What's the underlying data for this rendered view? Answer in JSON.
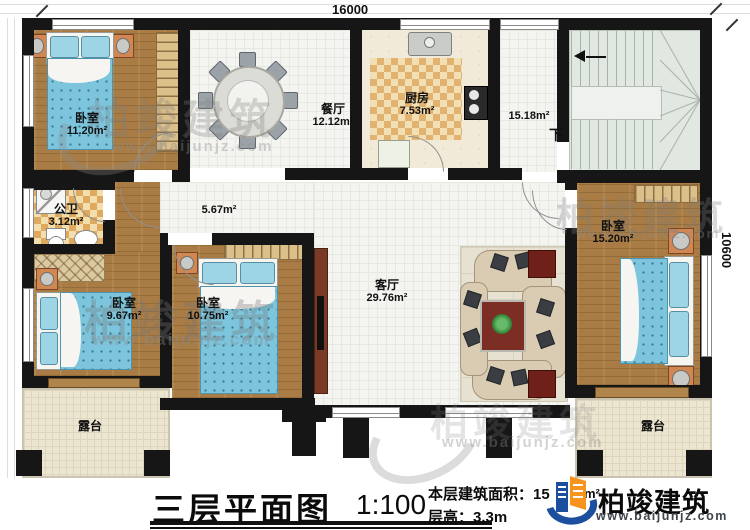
{
  "dimensions": {
    "top": "16000",
    "right": "10600"
  },
  "rooms": {
    "bedroom_tl": {
      "label": "卧室",
      "area": "11.20m²"
    },
    "dining": {
      "label": "餐厅",
      "area": "12.12m²"
    },
    "kitchen": {
      "label": "厨房",
      "area": "7.53m²"
    },
    "stair_hall": {
      "area": "15.18m²",
      "down": "下"
    },
    "hallway": {
      "area": "5.67m²"
    },
    "bathroom": {
      "label": "公卫",
      "area": "3.12m²"
    },
    "bedroom_bl": {
      "label": "卧室",
      "area": "9.67m²"
    },
    "bedroom_bm": {
      "label": "卧室",
      "area": "10.75m²"
    },
    "living": {
      "label": "客厅",
      "area": "29.76m²"
    },
    "bedroom_r": {
      "label": "卧室",
      "area": "15.20m²"
    },
    "terrace_l": {
      "label": "露台"
    },
    "terrace_r": {
      "label": "露台"
    }
  },
  "footer": {
    "title": "三层平面图",
    "scale": "1:100",
    "area_label": "本层建筑面积：15",
    "area_unit": "m²",
    "floor_height": "层高：3.3m"
  },
  "branding": {
    "name": "柏竣建筑",
    "url": "www.baijunjz.com"
  },
  "colors": {
    "wall": "#161616",
    "wood": "#a87c44",
    "tile": "#f4f4f1",
    "checker": "#dfa95f",
    "terrace": "#ece6d0",
    "bed_blue": "#7cc5dc",
    "stair": "#e1e7e1",
    "logo_blue": "#1c4f9e",
    "logo_orange": "#f7941e"
  }
}
